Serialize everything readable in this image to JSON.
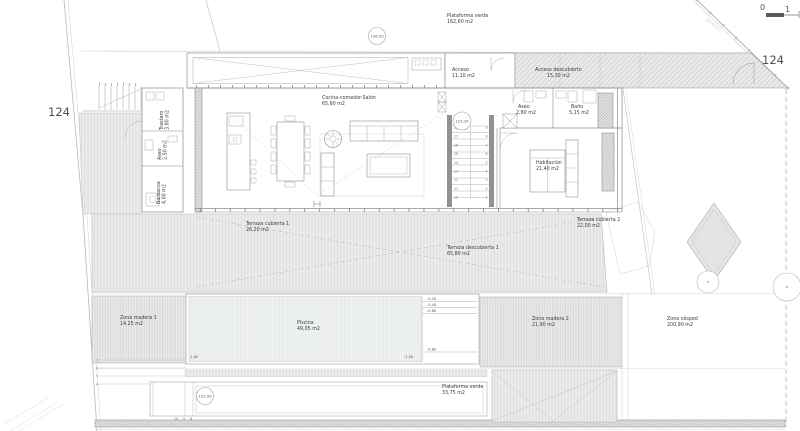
{
  "colors": {
    "background": "#ffffff",
    "hatch_line": "#d8d8d8",
    "wall": "#707070",
    "label_text": "#3d3d3d",
    "parcel_text": "#4f4f4f"
  },
  "parcel": {
    "left": "124",
    "right": "124"
  },
  "scale_bar": {
    "zero": "0",
    "one": "1"
  },
  "levels": {
    "upper": "126,00",
    "mid": "123,35",
    "lower": "122,00"
  },
  "boundary_dim": "24.43.57",
  "rooms": {
    "plataforma_top": {
      "name": "Plataforma verde",
      "area": "162,60 m2"
    },
    "acceso": {
      "name": "Acceso",
      "area": "11,10 m2"
    },
    "acceso_descubierto": {
      "name": "Acceso descubierto",
      "area": "15,30 m2"
    },
    "cocina": {
      "name": "Cocina-comedor-Salón",
      "area": "65,60 m2"
    },
    "aseo_planta": {
      "name": "Aseo",
      "area": "2,80 m2"
    },
    "bano": {
      "name": "Baño",
      "area": "5,15 m2"
    },
    "habitacion": {
      "name": "Habitación",
      "area": "21,40 m2"
    },
    "trastero": {
      "name": "Trastero",
      "area": "3,80 m2"
    },
    "aseo_exterior": {
      "name": "Aseo",
      "area": "2,50 m2"
    },
    "barbacoa": {
      "name": "Barbacoa",
      "area": "4,00 m2"
    },
    "terraza_cubierta_1": {
      "name": "Terraza cubierta 1",
      "area": "26,20 m2"
    },
    "terraza_descubierta_1": {
      "name": "Terraza descubierta 1",
      "area": "65,80 m2"
    },
    "terraza_cubierta_2": {
      "name": "Terraza cubierta 2",
      "area": "22,00 m2"
    },
    "zona_madera_1": {
      "name": "Zona madera 1",
      "area": "14,25 m2"
    },
    "piscina": {
      "name": "Piscina",
      "area": "49,05 m2"
    },
    "zona_madera_2": {
      "name": "Zona madera 2",
      "area": "21,90 m2"
    },
    "zona_cesped": {
      "name": "Zona césped",
      "area": "200,90 m2"
    },
    "plataforma_bottom": {
      "name": "Plataforma verde",
      "area": "33,75 m2"
    }
  },
  "pool_depths": {
    "d1": "-0,20",
    "d2": "-0,40",
    "d3": "-0,60",
    "d4": "-0,80",
    "deep": "-1,80",
    "shallow": "-1,00"
  },
  "stairs": {
    "left": [
      "18",
      "17",
      "16",
      "15",
      "14",
      "13",
      "12",
      "11",
      "10"
    ],
    "right": [
      "9",
      "8",
      "7",
      "6",
      "5",
      "4",
      "3",
      "2",
      "1"
    ]
  },
  "deck_steps": [
    "7",
    "6",
    "5",
    "4"
  ],
  "deck_steps_lower": [
    "10",
    "9",
    "8"
  ]
}
